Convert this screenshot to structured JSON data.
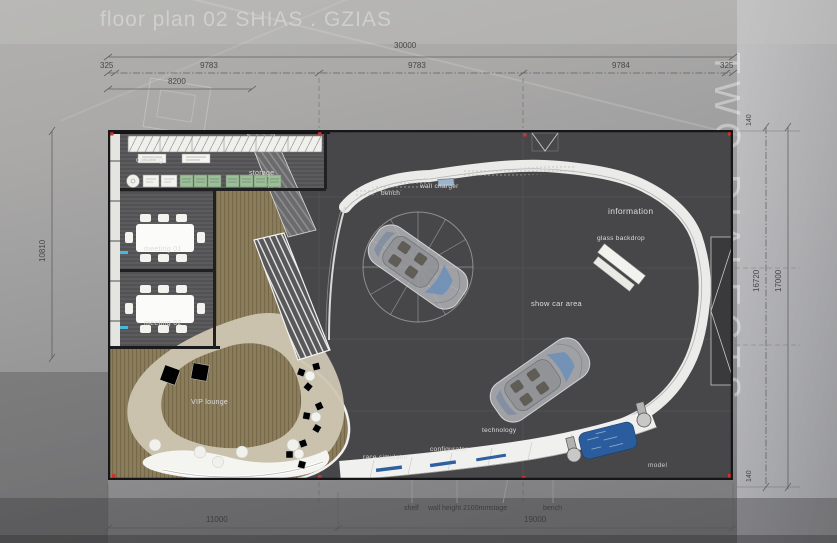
{
  "header": {
    "title": "floor plan 02 SHIAS . GZIAS"
  },
  "watermark": "TWO DIALECTS",
  "dimensions": {
    "top": {
      "total": "30000",
      "segments": [
        "325",
        "9783",
        "9783",
        "9784",
        "325"
      ],
      "sub": "8200"
    },
    "left": {
      "height": "10810"
    },
    "right": {
      "inner": "16720",
      "outer": "17000",
      "offset_top": "140",
      "offset_bottom": "140"
    },
    "bottom": {
      "left": "11000",
      "right": "19000"
    }
  },
  "rooms": {
    "catering": "catering",
    "storage": "storage",
    "meeting01": "meeting 01",
    "meeting02": "meeting 02",
    "vip_lounge": "VIP lounge",
    "show_car_area": "show car area"
  },
  "features": {
    "bench_left": "bench",
    "wall_charger": "wall charger",
    "bench_top": "bench",
    "information": "information",
    "glass_backdrop": "glass backdrop",
    "technology": "technology",
    "configurator": "configurator",
    "race_simulator": "race simulator",
    "model": "model",
    "shelf": "shelf",
    "wall_height": "wall height 2100mm",
    "stage": "stage",
    "bench_bottom": "bench"
  },
  "colors": {
    "floor_dark": "#47474a",
    "lounge_khaki": "#8b7d5c",
    "path_beige": "#cfc6b2",
    "band_white": "#ebebe9",
    "model_blue": "#2b5d9e",
    "marker_red": "#c8342e",
    "marker_cyan": "#49b6da"
  }
}
